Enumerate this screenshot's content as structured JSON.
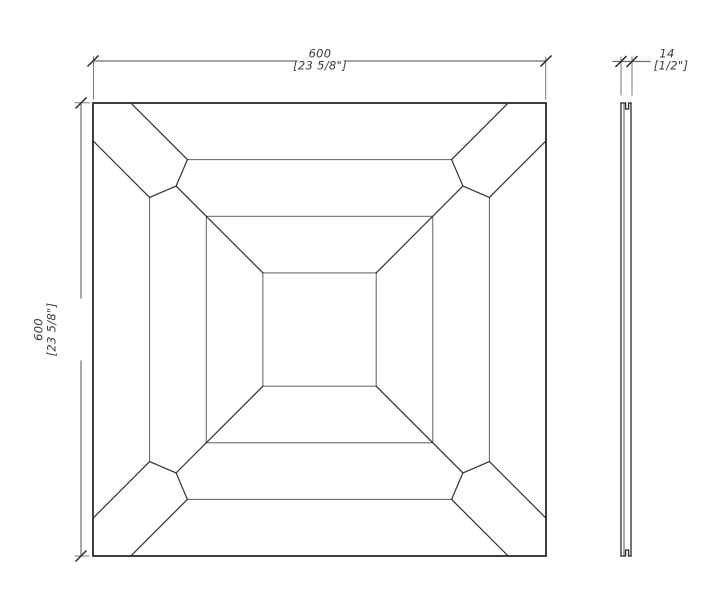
{
  "drawing": {
    "background": "#ffffff",
    "colors": {
      "outline": "#2a2a2a",
      "pattern_line": "#5f5f5f",
      "dimension_line": "#6e6e6e",
      "text": "#3a3a3a"
    },
    "dimensions": {
      "width": {
        "metric": "600",
        "imperial": "[23 5/8\"]"
      },
      "height": {
        "metric": "600",
        "imperial": "[23 5/8\"]"
      },
      "thickness": {
        "metric": "14",
        "imperial": "[1/2\"]"
      }
    }
  }
}
